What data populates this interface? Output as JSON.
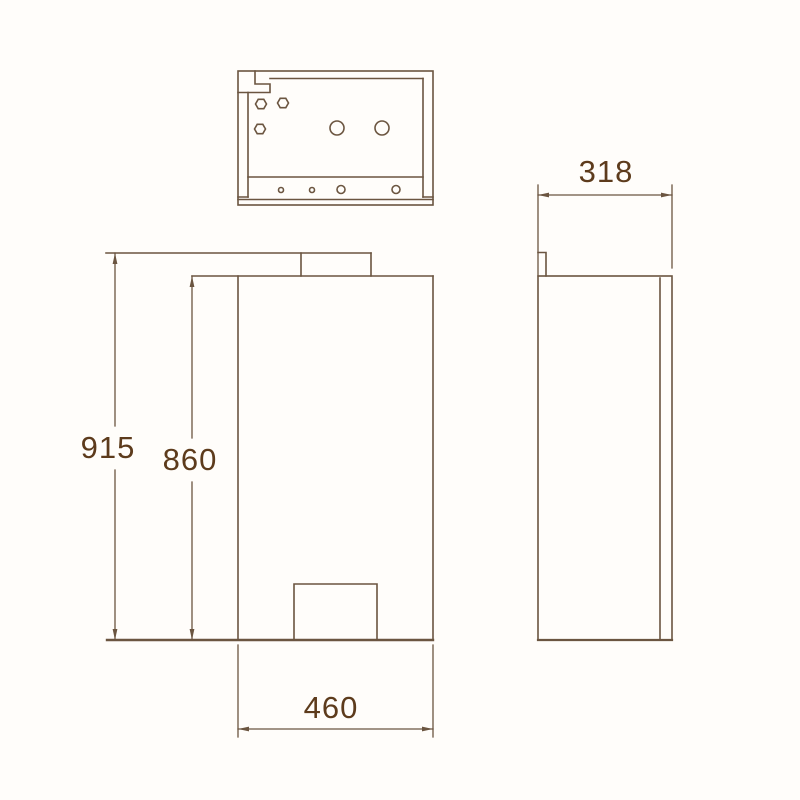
{
  "colors": {
    "background": "#fffdfa",
    "line": "#6b5540",
    "text": "#5d3b1c"
  },
  "dimensions": {
    "overall_height": "915",
    "body_height": "860",
    "body_width": "460",
    "body_depth": "318"
  }
}
